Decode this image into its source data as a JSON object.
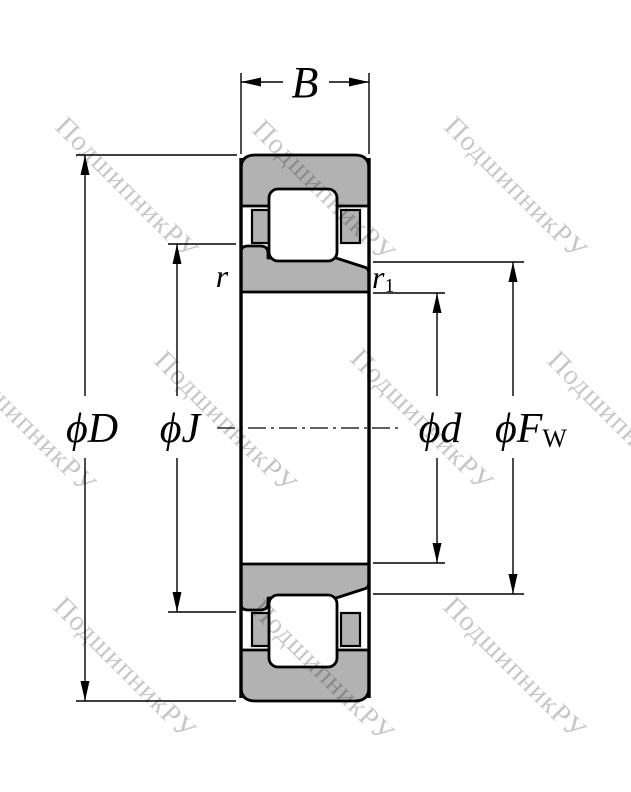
{
  "drawing": {
    "title": "cylindrical-roller-bearing-cross-section",
    "watermark": {
      "text": "ПодшипникРУ",
      "color_over_white": "#c7c7c7"
    },
    "dimensions": {
      "width": {
        "label": "B"
      },
      "outer_diameter": {
        "label": "ϕD"
      },
      "rib_diameter": {
        "label": "ϕJ"
      },
      "bore_diameter": {
        "label": "ϕd"
      },
      "raceway_diameter": {
        "label_main": "ϕF",
        "label_sub": "W"
      },
      "chamfer_outer": {
        "label": "r"
      },
      "chamfer_inner": {
        "label_main": "r",
        "label_sub": "1"
      }
    },
    "colors": {
      "ring_fill": "#b2b2b2",
      "line": "#000000",
      "background": "#ffffff"
    }
  }
}
